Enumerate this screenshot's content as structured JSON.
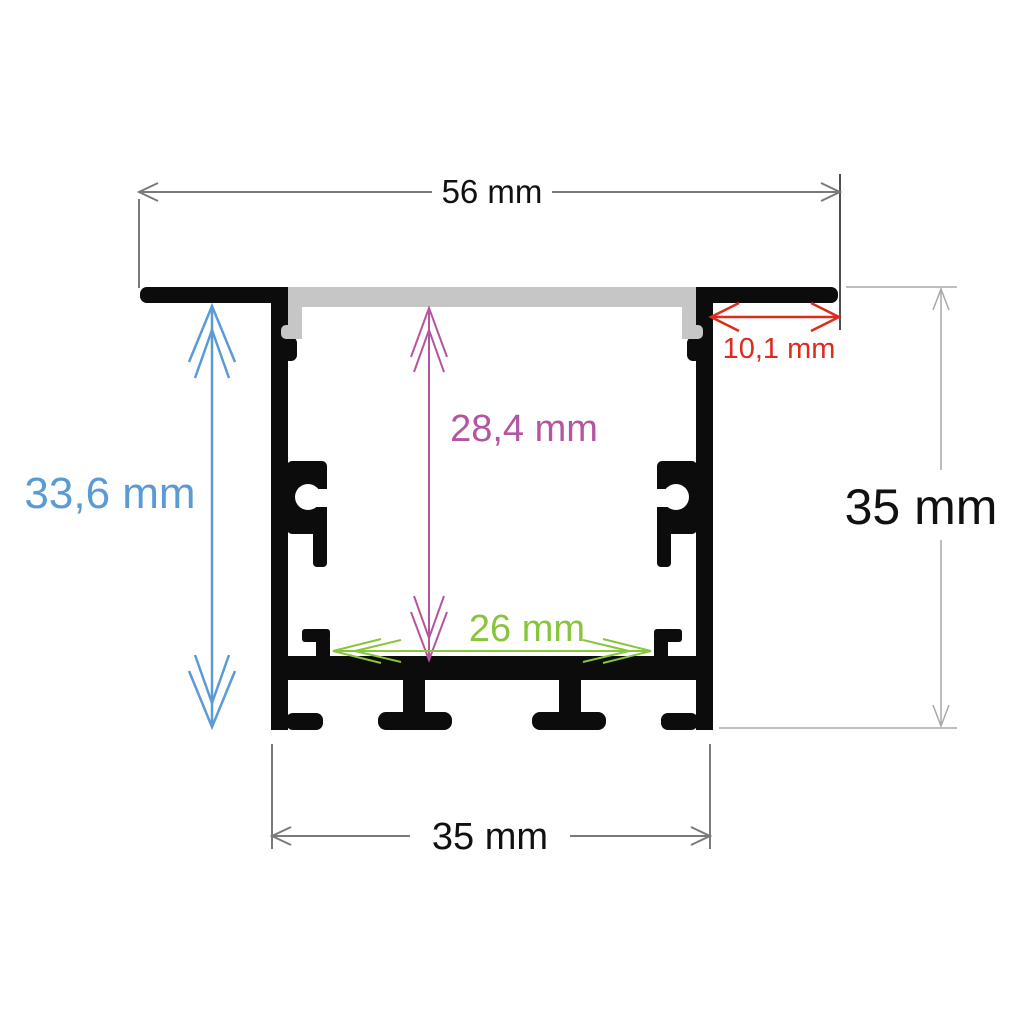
{
  "diagram": {
    "title": "Recessed LED aluminium profile cross-section with dimensions"
  },
  "labels": {
    "top_width": "56 mm",
    "left_height": "33,6 mm",
    "inner_height": "28,4 mm",
    "inner_width": "26 mm",
    "flange_right_width": "10,1 mm",
    "right_height": "35 mm",
    "bottom_width": "35 mm"
  },
  "colors": {
    "profile": "#0c0c0c",
    "diffuser": "#c6c6c6",
    "background": "#ffffff",
    "dim_gray": "#7a7a7a",
    "dim_gray_dark": "#4f4f4f",
    "dim_gray_light": "#a9a9a9",
    "text_black": "#111111",
    "blue": "#5b9bd5",
    "purple": "#b4559f",
    "green": "#88c43c",
    "red": "#dc2b1f"
  }
}
